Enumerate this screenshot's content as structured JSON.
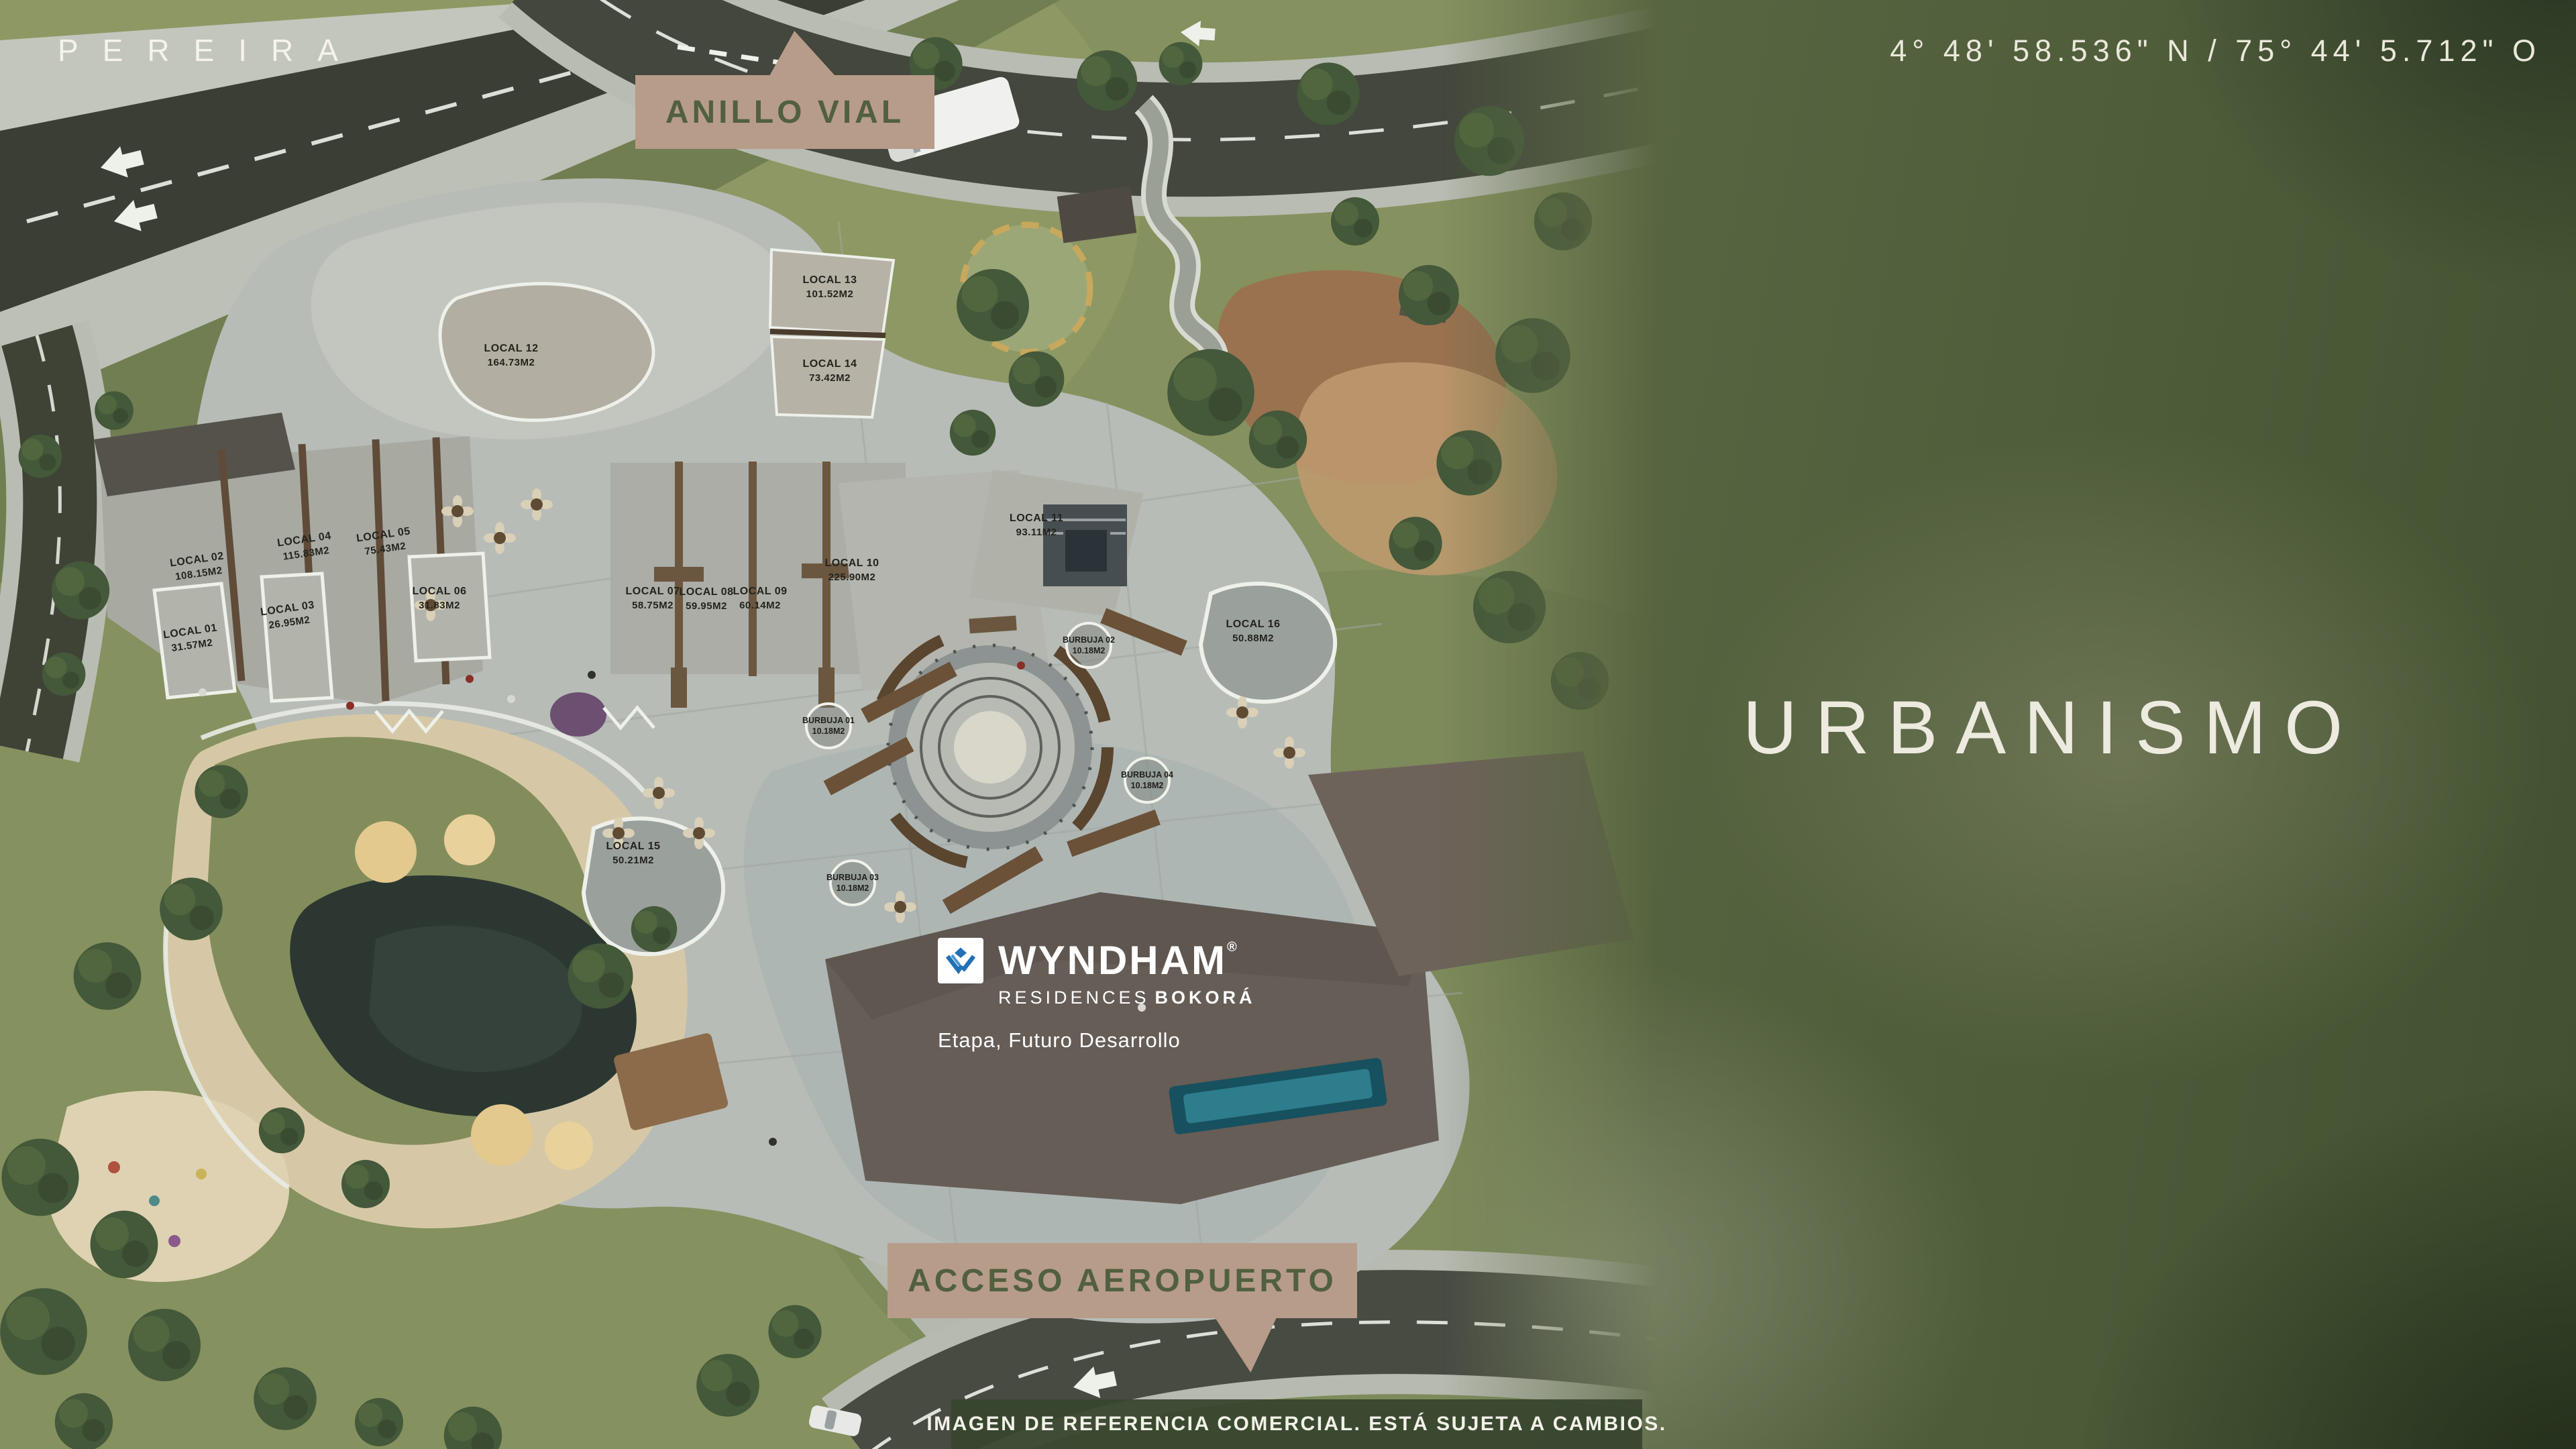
{
  "page": {
    "city": "PEREIRA",
    "coordinates": "4° 48' 58.536\" N   /   75° 44' 5.712\" O",
    "section_title": "URBANISMO",
    "disclaimer": "IMAGEN DE REFERENCIA COMERCIAL. ESTÁ SUJETA A CAMBIOS."
  },
  "callouts": {
    "ring_road": "ANILLO VIAL",
    "airport_access": "ACCESO AEROPUERTO"
  },
  "brand": {
    "name": "WYNDHAM",
    "registered": "®",
    "residences": "RESIDENCES",
    "bokora": "BOKORÁ",
    "phase": "Etapa, Futuro Desarrollo"
  },
  "map": {
    "locals": [
      {
        "name": "LOCAL 01",
        "area": "31.57M2"
      },
      {
        "name": "LOCAL 02",
        "area": "108.15M2"
      },
      {
        "name": "LOCAL 03",
        "area": "26.95M2"
      },
      {
        "name": "LOCAL 04",
        "area": "115.83M2"
      },
      {
        "name": "LOCAL 05",
        "area": "75.43M2"
      },
      {
        "name": "LOCAL 06",
        "area": "31.83M2"
      },
      {
        "name": "LOCAL 07",
        "area": "58.75M2"
      },
      {
        "name": "LOCAL 08",
        "area": "59.95M2"
      },
      {
        "name": "LOCAL 09",
        "area": "60.14M2"
      },
      {
        "name": "LOCAL 10",
        "area": "225.90M2"
      },
      {
        "name": "LOCAL 11",
        "area": "93.11M2"
      },
      {
        "name": "LOCAL 12",
        "area": "164.73M2"
      },
      {
        "name": "LOCAL 13",
        "area": "101.52M2"
      },
      {
        "name": "LOCAL 14",
        "area": "73.42M2"
      },
      {
        "name": "LOCAL 15",
        "area": "50.21M2"
      },
      {
        "name": "LOCAL 16",
        "area": "50.88M2"
      }
    ],
    "bubbles": [
      {
        "name": "BURBUJA 01",
        "area": "10.18M2"
      },
      {
        "name": "BURBUJA 02",
        "area": "10.18M2"
      },
      {
        "name": "BURBUJA 03",
        "area": "10.18M2"
      },
      {
        "name": "BURBUJA 04",
        "area": "10.18M2"
      }
    ]
  },
  "colors": {
    "callout_bg": "#b79c89",
    "callout_text": "#51603f",
    "panel_olive": "#4e5c3a",
    "cream_text": "#edeadf",
    "wyndham_blue": "#2170b8",
    "disclaimer_bg": "#38462f",
    "grass": "#85915f",
    "plaza": "#b7bcb7",
    "road": "#40453b",
    "sand": "#d6c8a6",
    "pond": "#2c3731",
    "future_roof": "#665d56"
  }
}
